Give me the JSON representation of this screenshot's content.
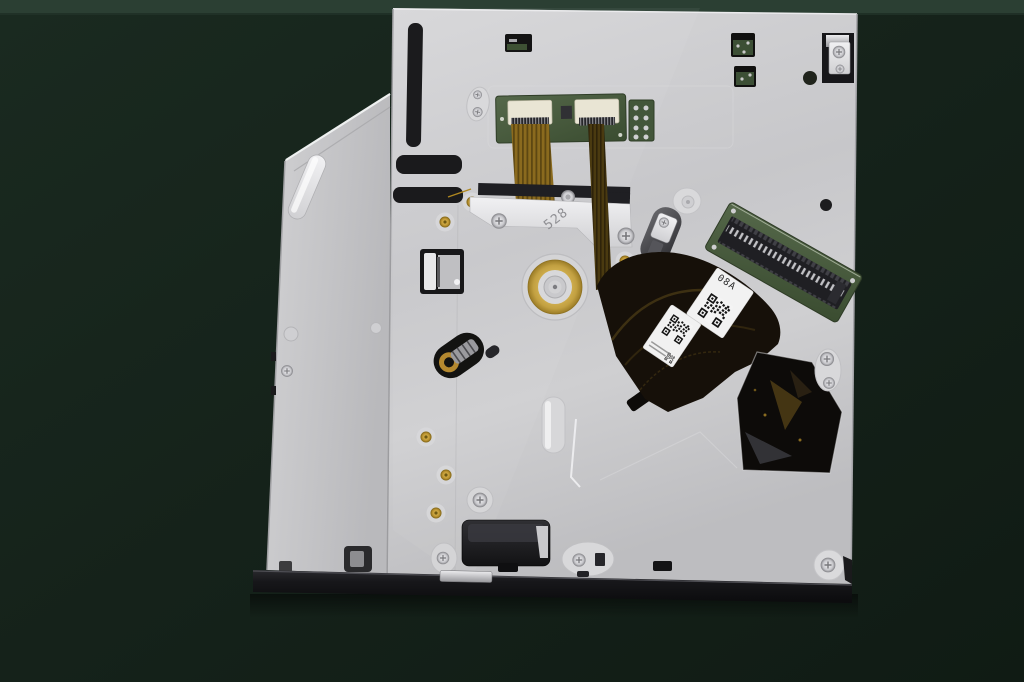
{
  "scene": {
    "subject": "slim optical disc drive, bottom view, on dark green mat",
    "colors": {
      "background": "#15221a",
      "surface_top_edge": "#2b3f33",
      "chassis_metal": "#c9c9cc",
      "tray_metal": "#c4c4c7",
      "front_bezel": "#17171a",
      "pcb_green": "#46593a",
      "ribbon_gold": "#8a6a1e",
      "flex_cable_dark": "#161009",
      "spindle_gold": "#c2a041",
      "label_white": "#f1f1f1"
    }
  },
  "markings": {
    "chassis_stamp": "528",
    "flex_label_code": "08A"
  },
  "components": {
    "tray": "disc tray edge",
    "chassis": "bottom chassis plate",
    "spindle": "spindle motor",
    "sata": "SATA interface board",
    "ffc_board": "flex connector board",
    "flex": "flex cable with QR labels",
    "bezel": "front bezel"
  }
}
